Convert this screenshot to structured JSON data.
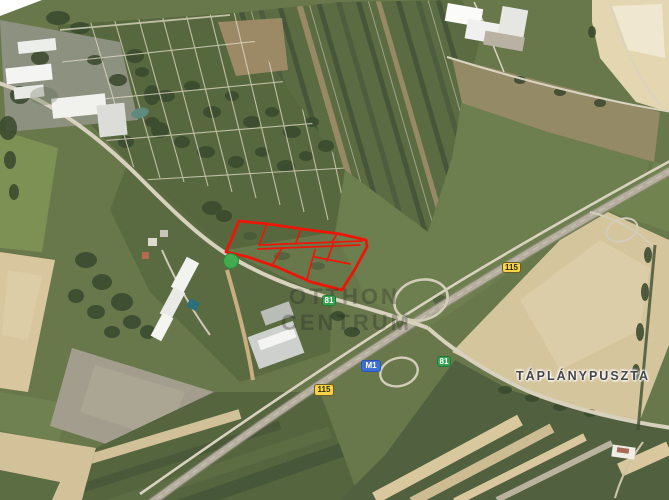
{
  "map": {
    "view_type": "satellite",
    "place_label": "TÁPLÁNYPUSZTA",
    "watermark": {
      "line1": "OTTHON",
      "line2": "CENTRUM"
    },
    "shields": [
      {
        "label": "115",
        "route_type": "secondary-road",
        "color": "#f8d24b"
      },
      {
        "label": "115",
        "route_type": "secondary-road",
        "color": "#f8d24b"
      },
      {
        "label": "M1",
        "route_type": "motorway",
        "color": "#3d6fd6"
      },
      {
        "label": "81",
        "route_type": "main-road",
        "color": "#35a24f"
      },
      {
        "label": "81",
        "route_type": "main-road",
        "color": "#35a24f"
      }
    ],
    "colors": {
      "parcel_outline": "#ec1607",
      "place_label_text": "#454545",
      "field_green": "#68784b",
      "field_tan": "#d5c59d",
      "road": "#d7d1be"
    }
  }
}
